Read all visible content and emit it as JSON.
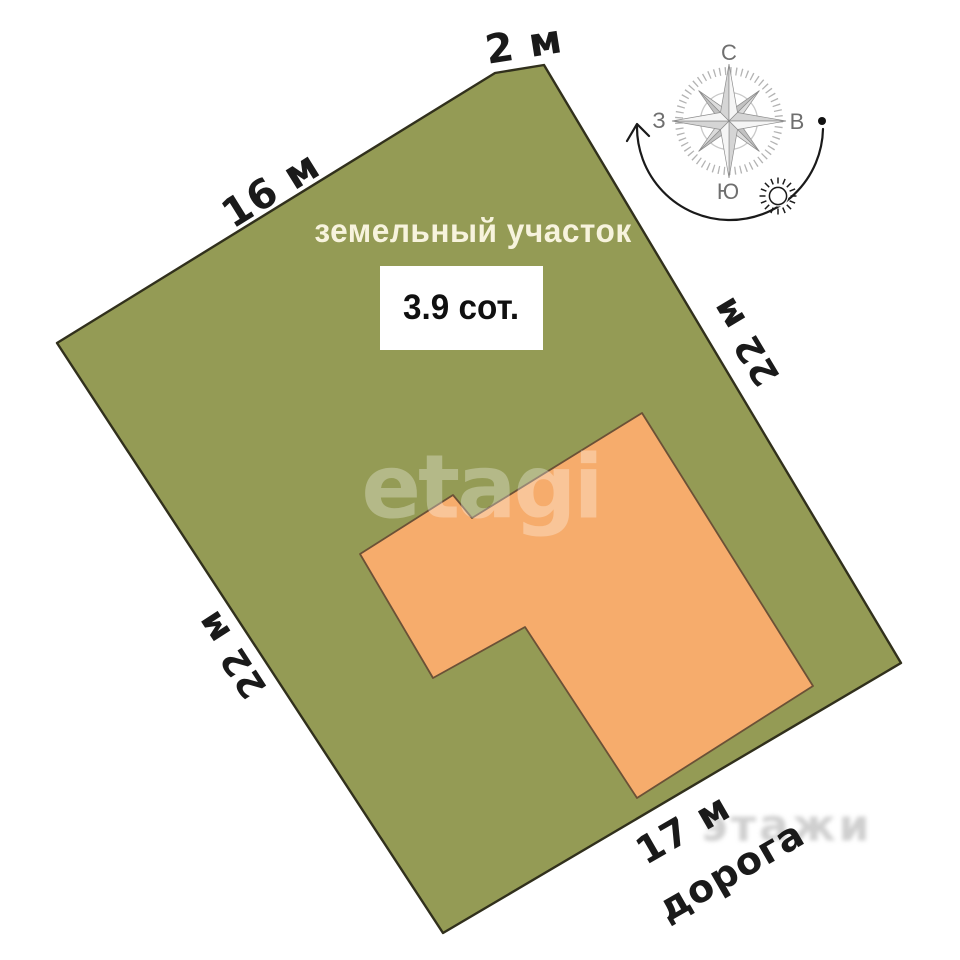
{
  "diagram": {
    "title": "земельный участок",
    "area": "3.9 сот.",
    "road_label": "дорога",
    "dimensions": {
      "top_edge": "2 м",
      "upper_left_edge": "16 м",
      "right_edge": "22 м",
      "left_edge": "22 м",
      "bottom_edge": "17 м"
    },
    "colors": {
      "plot_fill": "#949b55",
      "plot_stroke": "#31301c",
      "building_fill": "#f6ac6c",
      "building_stroke": "#6b5136",
      "title_text": "#f7f3dd",
      "label_text": "#1a1a1a"
    }
  },
  "compass": {
    "north": "С",
    "east": "В",
    "south": "Ю",
    "west": "З"
  },
  "watermarks": {
    "center": "etagi",
    "bottom": "этажи"
  }
}
